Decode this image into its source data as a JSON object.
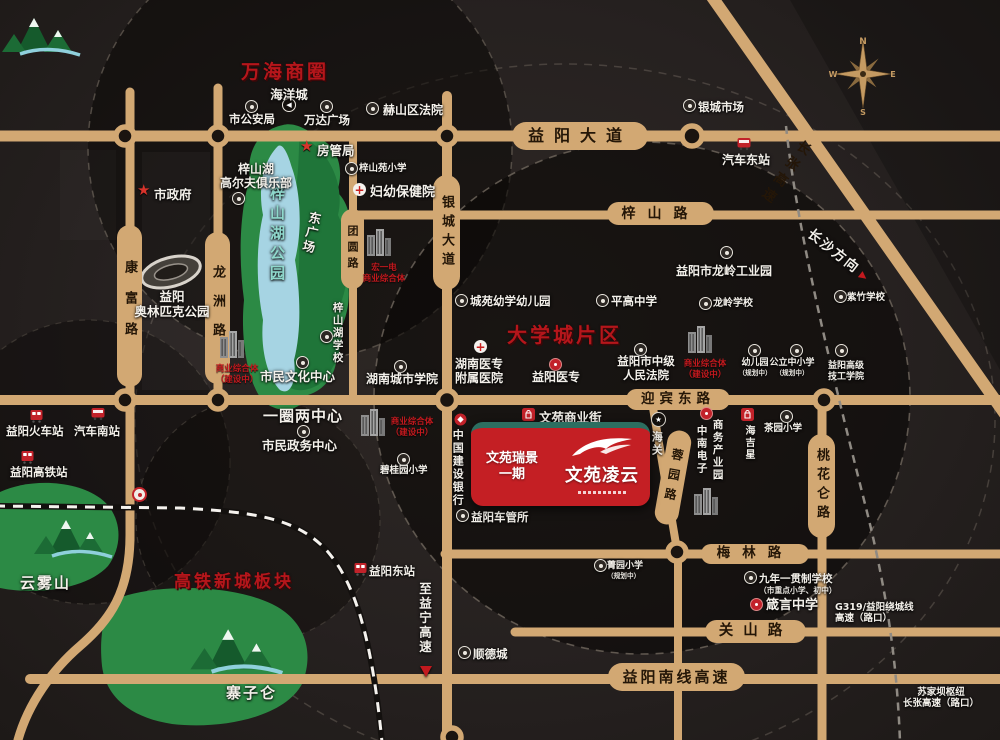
{
  "colors": {
    "road": "#d2a873",
    "accent_red": "#c2191e",
    "project_red": "#c41f24",
    "teal_strip": "#2c6e60",
    "park_green": "#2c8a45",
    "lake_blue": "#a6d4e3",
    "zone_red": "#b5161b"
  },
  "zones": [
    {
      "id": "wanhai-business",
      "label": "万海商圈",
      "x": 241,
      "y": 57,
      "fs": 19
    },
    {
      "id": "daxuecheng",
      "label": "大学城片区",
      "x": 507,
      "y": 319,
      "fs": 20
    },
    {
      "id": "gaotie-xincheng",
      "label": "高铁新城板块",
      "x": 174,
      "y": 567,
      "fs": 17
    }
  ],
  "roads": [
    {
      "id": "yiyang-avenue",
      "label": "益阳大道",
      "o": "h",
      "x": 512,
      "y": 122,
      "w": 136,
      "h": 28,
      "fs": 16,
      "ls": 10
    },
    {
      "id": "zishan-road",
      "label": "梓山路",
      "o": "h",
      "x": 607,
      "y": 202,
      "w": 107,
      "h": 23,
      "fs": 14,
      "ls": 12
    },
    {
      "id": "yingbin-east-road",
      "label": "迎宾东路",
      "o": "h",
      "x": 626,
      "y": 389,
      "w": 104,
      "h": 21,
      "fs": 13.5,
      "ls": 5
    },
    {
      "id": "meilin-road",
      "label": "梅林路",
      "o": "h",
      "x": 701,
      "y": 544,
      "w": 108,
      "h": 20,
      "fs": 13.5,
      "ls": 12
    },
    {
      "id": "guanshan-road",
      "label": "关山路",
      "o": "h",
      "x": 705,
      "y": 620,
      "w": 101,
      "h": 23,
      "fs": 14.5,
      "ls": 10
    },
    {
      "id": "yiyang-south-expressway",
      "label": "益阳南线高速",
      "o": "h",
      "x": 608,
      "y": 663,
      "w": 137,
      "h": 28,
      "fs": 15,
      "ls": 3
    },
    {
      "id": "kangfu-road",
      "label": "康富路",
      "o": "v",
      "x": 117,
      "y": 225,
      "w": 25,
      "h": 162,
      "fs": 13,
      "ls": 18
    },
    {
      "id": "longzhou-road",
      "label": "龙洲路",
      "o": "v",
      "x": 205,
      "y": 232,
      "w": 25,
      "h": 152,
      "fs": 13,
      "ls": 16
    },
    {
      "id": "tuanyuan-road",
      "label": "团圆路",
      "o": "v",
      "x": 341,
      "y": 209,
      "w": 23,
      "h": 80,
      "fs": 11,
      "ls": 5
    },
    {
      "id": "yincheng-avenue",
      "label": "银城大道",
      "o": "v",
      "x": 433,
      "y": 175,
      "w": 27,
      "h": 115,
      "fs": 13,
      "ls": 6
    },
    {
      "id": "rongyuan-road",
      "label": "蓉园路",
      "o": "v",
      "x": 661,
      "y": 430,
      "w": 24,
      "h": 95,
      "fs": 12,
      "ls": 8,
      "rotate": 10
    },
    {
      "id": "taohualun-road",
      "label": "桃花仑路",
      "o": "v",
      "x": 808,
      "y": 434,
      "w": 27,
      "h": 104,
      "fs": 13,
      "ls": 6
    }
  ],
  "pois": [
    {
      "id": "zishanhu-park-label",
      "label": "梓山湖公园",
      "x": 268,
      "y": 185,
      "fs": 15,
      "vertical": true,
      "vh": 135,
      "color": "#8fd8cc",
      "ls": 5
    },
    {
      "id": "dong-square",
      "label": "东广场",
      "x": 308,
      "y": 210,
      "fs": 12.5,
      "vertical": true,
      "vh": 58,
      "rotate": 12
    },
    {
      "id": "olympic-park-label",
      "lines": [
        "益阳",
        "奥林匹克公园"
      ],
      "x": 128,
      "y": 289,
      "w": 88,
      "fs": 12.5
    },
    {
      "id": "yunwu-mountain-label",
      "label": "云雾山",
      "x": 20,
      "y": 574,
      "fs": 15,
      "ls": 2
    },
    {
      "id": "zhaizi-mountain-label",
      "label": "寨子仑",
      "x": 226,
      "y": 684,
      "fs": 15,
      "ls": 2
    },
    {
      "id": "haiyangcheng",
      "label": "海洋城",
      "icon": "cd",
      "ix": 282,
      "iy": 98,
      "x": 260,
      "y": 87,
      "w": 58,
      "fs": 12.5
    },
    {
      "id": "shigonganju",
      "label": "市公安局",
      "icon": "c",
      "ix": 245,
      "iy": 100,
      "x": 221,
      "y": 113,
      "w": 62,
      "fs": 11.5
    },
    {
      "id": "wanda-plaza",
      "label": "万达广场",
      "icon": "c",
      "ix": 320,
      "iy": 100,
      "x": 297,
      "y": 114,
      "w": 60,
      "fs": 11.5
    },
    {
      "id": "heshan-court",
      "label": "赫山区法院",
      "icon": "c",
      "ix": 366,
      "iy": 102,
      "x": 383,
      "y": 103,
      "fs": 12
    },
    {
      "id": "fangguanju",
      "label": "房管局",
      "icon": "st",
      "ix": 300,
      "iy": 139,
      "x": 317,
      "y": 143,
      "fs": 12.5
    },
    {
      "id": "shizhengfu",
      "label": "市政府",
      "icon": "st",
      "ix": 137,
      "iy": 183,
      "x": 154,
      "y": 187,
      "fs": 12.5
    },
    {
      "id": "zishanyuan-primary",
      "label": "梓山苑小学",
      "icon": "c",
      "ix": 345,
      "iy": 162,
      "x": 359,
      "y": 163,
      "fs": 9.5
    },
    {
      "id": "fuyou-baojianyuan",
      "label": "妇幼保健院",
      "icon": "cr",
      "ix": 353,
      "iy": 183,
      "x": 370,
      "y": 185,
      "fs": 13
    },
    {
      "id": "golf-club",
      "lines": [
        "梓山湖",
        "高尔夫俱乐部"
      ],
      "icon": "c",
      "ix": 232,
      "iy": 192,
      "x": 215,
      "y": 162,
      "w": 82,
      "fs": 12
    },
    {
      "id": "shimin-culture-center",
      "label": "市民文化中心",
      "icon": "c",
      "ix": 296,
      "iy": 356,
      "x": 260,
      "y": 369,
      "fs": 12.5
    },
    {
      "id": "complex-culture",
      "icon": "bld",
      "ix": 219,
      "iy": 328,
      "lines": [
        "商业综合体",
        "（建设中）"
      ],
      "x": 212,
      "y": 364,
      "w": 50,
      "fs": 8.5,
      "red": true
    },
    {
      "id": "zishanhu-school",
      "label": "梓山湖学校",
      "icon": "c",
      "ix": 320,
      "iy": 330,
      "x": 331,
      "y": 302,
      "fs": 10.5,
      "vertical": true,
      "vh": 74
    },
    {
      "id": "hongyi-complex",
      "icon": "bld",
      "ix": 366,
      "iy": 226,
      "lines": [
        "宏一电",
        "商业综合体"
      ],
      "x": 357,
      "y": 263,
      "w": 54,
      "fs": 8.5,
      "red": true
    },
    {
      "id": "yiquan-liangzhongxin",
      "label": "一圈两中心",
      "x": 263,
      "y": 407,
      "fs": 15,
      "ls": 1
    },
    {
      "id": "shimin-zhengwu",
      "label": "市民政务中心",
      "icon": "c",
      "ix": 297,
      "iy": 425,
      "x": 262,
      "y": 438,
      "fs": 12.5
    },
    {
      "id": "biguiyuan-primary",
      "label": "碧桂园小学",
      "icon": "c",
      "ix": 397,
      "iy": 453,
      "x": 380,
      "y": 465,
      "fs": 9.5
    },
    {
      "id": "complex-center",
      "icon": "bld",
      "ix": 360,
      "iy": 406,
      "lines": [
        "商业综合体",
        "（建设中）"
      ],
      "x": 387,
      "y": 417,
      "w": 50,
      "fs": 8.5,
      "red": true
    },
    {
      "id": "chengyuan-kindergarten",
      "label": "城苑幼学幼儿园",
      "icon": "c",
      "ix": 455,
      "iy": 294,
      "x": 470,
      "y": 295,
      "fs": 11.5
    },
    {
      "id": "pinggao-school",
      "label": "平高中学",
      "icon": "c",
      "ix": 596,
      "iy": 294,
      "x": 611,
      "y": 295,
      "fs": 11.5
    },
    {
      "id": "hunan-yizhuan-hospital",
      "icon": "cr",
      "ix": 474,
      "iy": 340,
      "lines": [
        "湖南医专",
        "附属医院"
      ],
      "x": 450,
      "y": 357,
      "w": 58,
      "fs": 12
    },
    {
      "id": "yiyang-yizhuan",
      "label": "益阳医专",
      "icon": "rd",
      "ix": 549,
      "iy": 358,
      "x": 532,
      "y": 370,
      "fs": 12
    },
    {
      "id": "intermediate-court",
      "icon": "c",
      "ix": 634,
      "iy": 343,
      "lines": [
        "益阳市中级",
        "人民法院"
      ],
      "x": 608,
      "y": 355,
      "w": 76,
      "fs": 11.5
    },
    {
      "id": "hunan-city-college",
      "label": "湖南城市学院",
      "icon": "c",
      "ix": 394,
      "iy": 360,
      "x": 366,
      "y": 372,
      "fs": 12
    },
    {
      "id": "longling-industrial",
      "label": "益阳市龙岭工业园",
      "icon": "c",
      "ix": 720,
      "iy": 246,
      "x": 676,
      "y": 264,
      "fs": 12
    },
    {
      "id": "longling-school",
      "label": "龙岭学校",
      "icon": "c",
      "ix": 699,
      "iy": 297,
      "x": 713,
      "y": 298,
      "fs": 10
    },
    {
      "id": "complex-right",
      "icon": "bld",
      "ix": 687,
      "iy": 323,
      "lines": [
        "商业综合体",
        "（建设中）"
      ],
      "x": 680,
      "y": 359,
      "w": 50,
      "fs": 8.5,
      "red": true
    },
    {
      "id": "kindergarten-planned",
      "icon": "c",
      "ix": 748,
      "iy": 344,
      "label": "幼儿园",
      "sub": "（规划中）",
      "x": 733,
      "y": 358,
      "w": 44,
      "fs": 9
    },
    {
      "id": "public-school-planned",
      "icon": "c",
      "ix": 790,
      "iy": 344,
      "label": "公立中小学",
      "sub": "（规划中）",
      "x": 766,
      "y": 358,
      "w": 52,
      "fs": 9
    },
    {
      "id": "jigong-college",
      "icon": "c",
      "ix": 835,
      "iy": 344,
      "lines": [
        "益阳高级",
        "技工学院"
      ],
      "x": 822,
      "y": 361,
      "w": 48,
      "fs": 9
    },
    {
      "id": "zizhu-school",
      "label": "紫竹学校",
      "icon": "c",
      "ix": 834,
      "iy": 290,
      "x": 847,
      "y": 292,
      "fs": 9.5
    },
    {
      "id": "yincheng-market",
      "label": "银城市场",
      "icon": "c",
      "ix": 683,
      "iy": 99,
      "x": 698,
      "y": 101,
      "fs": 11.5
    },
    {
      "id": "qiche-dongzhan",
      "label": "汽车东站",
      "icon": "bus",
      "ix": 737,
      "iy": 137,
      "x": 722,
      "y": 153,
      "fs": 12
    },
    {
      "id": "changzhang-expressway-label",
      "label": "长张高速",
      "x": 800,
      "y": 136,
      "fs": 13.5,
      "vertical": true,
      "vh": 108,
      "rotate": 36,
      "dark": true,
      "ls": 6
    },
    {
      "id": "changsha-direction",
      "label": "长沙方向",
      "x": 814,
      "y": 226,
      "fs": 13.5,
      "rotate": 38,
      "arrow": "se",
      "ls": 2
    },
    {
      "id": "yiyang-railway-station",
      "label": "益阳火车站",
      "icon": "train",
      "ix": 30,
      "iy": 409,
      "x": 6,
      "y": 425,
      "fs": 11.5
    },
    {
      "id": "qiche-nanzhan",
      "label": "汽车南站",
      "icon": "bus",
      "ix": 91,
      "iy": 407,
      "x": 74,
      "y": 425,
      "fs": 11.5
    },
    {
      "id": "yiyang-gaotie-station",
      "label": "益阳高铁站",
      "icon": "train",
      "ix": 21,
      "iy": 450,
      "x": 10,
      "y": 466,
      "fs": 11.5
    },
    {
      "id": "railway-logo",
      "icon": "rail",
      "ix": 132,
      "iy": 487
    },
    {
      "id": "yiyang-east-station",
      "label": "益阳东站",
      "icon": "train",
      "ix": 354,
      "iy": 562,
      "x": 369,
      "y": 565,
      "fs": 11.5
    },
    {
      "id": "zhiyining-expressway",
      "label": "至益宁高速",
      "x": 417,
      "y": 582,
      "fs": 12.5,
      "vertical": true,
      "vh": 76,
      "arrow": "down"
    },
    {
      "id": "shundecheng",
      "label": "顺德城",
      "icon": "c",
      "ix": 458,
      "iy": 646,
      "x": 473,
      "y": 648,
      "fs": 11.5
    },
    {
      "id": "jingyuan-primary",
      "label": "菁园小学",
      "sub": "（规划中）",
      "icon": "c",
      "ix": 594,
      "iy": 559,
      "x": 607,
      "y": 561,
      "fs": 9
    },
    {
      "id": "jiunian-school",
      "label": "九年一贯制学校",
      "sub": "（市重点小学、初中）",
      "icon": "c",
      "ix": 744,
      "iy": 571,
      "x": 759,
      "y": 573,
      "fs": 10.5
    },
    {
      "id": "zhenyan-school",
      "label": "箴言中学",
      "icon": "rd",
      "ix": 750,
      "iy": 598,
      "x": 766,
      "y": 598,
      "fs": 13
    },
    {
      "id": "g319-interchange",
      "lines": [
        "G319/益阳绕城线",
        "高速（路口）"
      ],
      "x": 835,
      "y": 602,
      "fs": 9.5
    },
    {
      "id": "sujiaba-interchange",
      "lines": [
        "苏家坝枢纽",
        "长张高速（路口）"
      ],
      "x": 896,
      "y": 687,
      "w": 90,
      "fs": 9.5
    },
    {
      "id": "chegansuo",
      "label": "益阳车管所",
      "icon": "c",
      "ix": 456,
      "iy": 509,
      "x": 471,
      "y": 511,
      "fs": 11.5
    },
    {
      "id": "wenyuan-street",
      "label": "文苑商业街",
      "icon": "shop",
      "ix": 522,
      "iy": 408,
      "x": 539,
      "y": 410,
      "fs": 12.5
    },
    {
      "id": "haiguan",
      "label": "海关",
      "icon": "cust",
      "ix": 651,
      "iy": 412,
      "x": 650,
      "y": 431,
      "fs": 11,
      "vertical": true,
      "vh": 40
    },
    {
      "id": "ccb-bank",
      "label": "中国建设银行",
      "icon": "bank",
      "ix": 454,
      "iy": 413,
      "x": 451,
      "y": 429,
      "fs": 11,
      "vertical": true,
      "vh": 82
    },
    {
      "id": "haijixing",
      "label": "海吉星",
      "icon": "shop",
      "ix": 741,
      "iy": 408,
      "x": 742,
      "y": 425,
      "fs": 10,
      "vertical": true,
      "vh": 46
    },
    {
      "id": "shangwu-park",
      "label": "商务产业园",
      "x": 711,
      "y": 419,
      "fs": 10.5,
      "vertical": true,
      "vh": 78
    },
    {
      "id": "zhongnan-electronics",
      "label": "中南电子",
      "icon": "rd",
      "ix": 700,
      "iy": 407,
      "x": 695,
      "y": 425,
      "fs": 10.5,
      "vertical": true,
      "vh": 62
    },
    {
      "id": "zhongnan-buildings",
      "icon": "bld",
      "ix": 693,
      "iy": 485
    },
    {
      "id": "chayuan-primary",
      "label": "茶园小学",
      "icon": "c",
      "ix": 780,
      "iy": 410,
      "x": 764,
      "y": 423,
      "fs": 9.5
    }
  ],
  "project": {
    "phase_line1": "文苑瑞景",
    "phase_line2": "一期",
    "name": "文苑凌云",
    "street_label": "文苑商业街"
  },
  "compass": {
    "n": "N",
    "w": "W",
    "e": "E",
    "s": "S"
  }
}
